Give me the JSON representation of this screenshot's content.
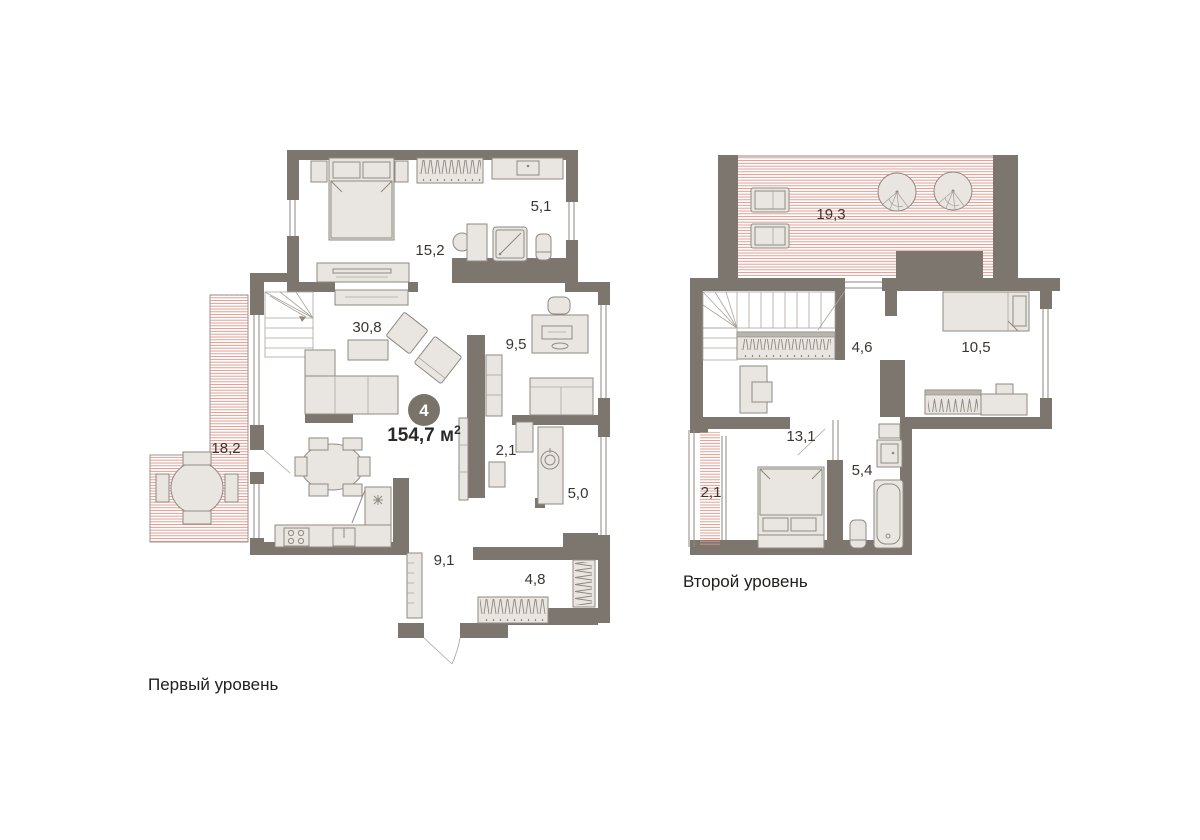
{
  "badge": {
    "number": "4",
    "area_text": "154,7 м",
    "area_sup": "2"
  },
  "levels": [
    {
      "caption": "Первый уровень",
      "rooms": {
        "bedroom": {
          "area": "15,2"
        },
        "bathroom": {
          "area": "5,1"
        },
        "living": {
          "area": "30,8"
        },
        "office": {
          "area": "9,5"
        },
        "corridor": {
          "area": "2,1"
        },
        "laundry": {
          "area": "5,0"
        },
        "terrace": {
          "area": "18,2"
        },
        "hallway": {
          "area": "9,1"
        },
        "wardrobe": {
          "area": "4,8"
        }
      }
    },
    {
      "caption": "Второй уровень",
      "rooms": {
        "terrace": {
          "area": "19,3"
        },
        "hall": {
          "area": "4,6"
        },
        "bedroom": {
          "area": "10,5"
        },
        "kidsroom": {
          "area": "13,1"
        },
        "bathroom": {
          "area": "5,4"
        },
        "balcony": {
          "area": "2,1"
        }
      }
    }
  ],
  "colors": {
    "wall": "#7d766e",
    "terrace_hatch": "#df9288",
    "furniture_fill": "#e9e6e2",
    "furniture_stroke": "#8f8981",
    "badge_circle": "#7a736a",
    "label_text": "#3a3733"
  }
}
